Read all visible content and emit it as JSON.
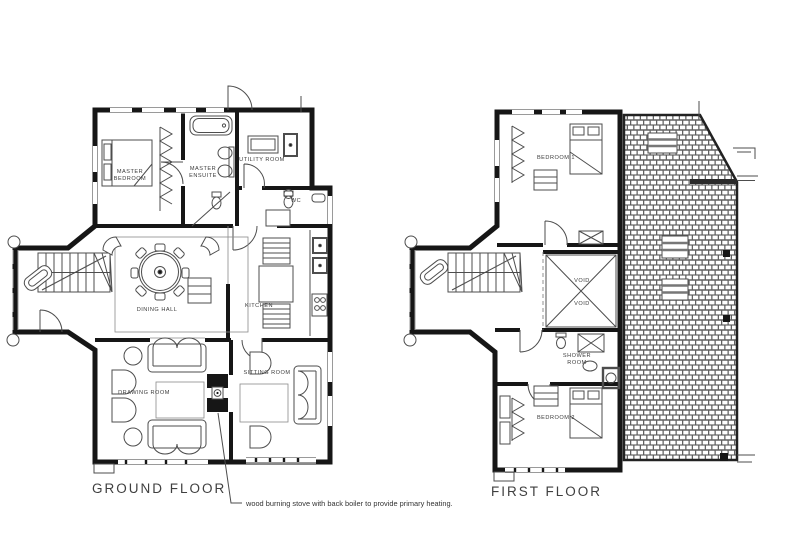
{
  "document": {
    "type": "architectural floor plan drawing",
    "background": "#ffffff"
  },
  "colors": {
    "wall": "#161616",
    "furniture_line": "#4d4d4d",
    "window_line": "#9a9a9a",
    "roof_tile_line": "#555555",
    "text": "#3c3c3c"
  },
  "ground_floor": {
    "title": "GROUND FLOOR",
    "rooms": {
      "master_bedroom": [
        "MASTER",
        "BEDROOM"
      ],
      "master_ensuite": [
        "MASTER",
        "ENSUITE"
      ],
      "utility_room": "UTILITY ROOM",
      "wc": "WC",
      "dining_hall": "DINING HALL",
      "kitchen": "KITCHEN",
      "drawing_room": "DRAWING ROOM",
      "sitting_room": "SITTING ROOM"
    }
  },
  "first_floor": {
    "title": "FIRST FLOOR",
    "rooms": {
      "bedroom_1": "BEDROOM 1",
      "void_upper": "VOID",
      "void_lower": "VOID",
      "shower_room": [
        "SHOWER",
        "ROOM"
      ],
      "bedroom_2": "BEDROOM 2"
    }
  },
  "annotation": {
    "stove_note": "wood burning stove with back boiler to provide primary heating."
  }
}
